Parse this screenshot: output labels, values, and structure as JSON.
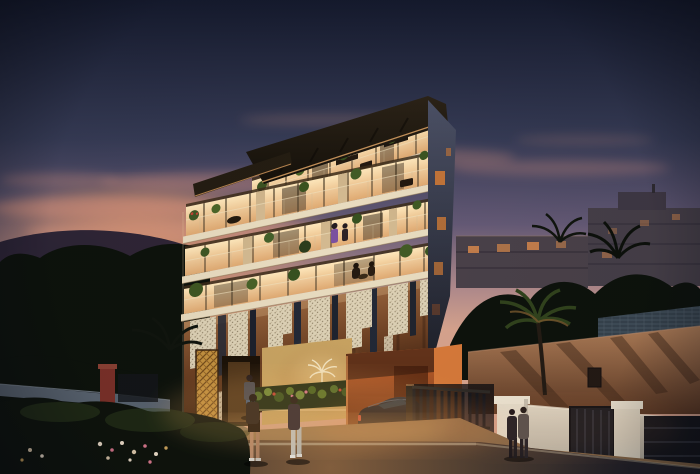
{
  "meta": {
    "description": "Dusk architectural rendering of a modern five-storey apartment residence with warmly lit balconies, decorative hanging mosaic facade panels, palm garden, street with pedestrians and a black sports coupe in the driveway",
    "time_of_day": "dusk"
  },
  "scene": {
    "main_building": {
      "label": "new-build residence",
      "storeys_visible": 5,
      "balcony_rows": 4,
      "features": [
        "dark roof slab with warm soffit lighting",
        "glass balcony railings",
        "potted plants and red geraniums on balconies",
        "hanging skyline-shaped mosaic panels",
        "golden lattice entrance panel",
        "palm-tree entrance emblem",
        "orange-lit garage recess"
      ]
    },
    "entrance_sign": {
      "emblem": "palm tree",
      "text_legible": false
    },
    "vehicles": [
      {
        "type": "black sports coupe",
        "location": "driveway",
        "count": 1
      }
    ],
    "pedestrians": [
      {
        "label": "couple crossing the street",
        "count": 2
      },
      {
        "label": "person on entrance walkway",
        "count": 1
      },
      {
        "label": "couple walking past boundary wall",
        "count": 2
      }
    ],
    "people_on_balconies": [
      {
        "label": "figure in purple on balcony",
        "count": 1
      },
      {
        "label": "seated figures on terrace",
        "count": 2
      }
    ],
    "background": {
      "apartment_blocks": 2,
      "lit_windows_approx": 8,
      "hills": "left horizon silhouette",
      "vegetation": "palm and tree silhouettes"
    },
    "street": {
      "road_edge_line": true,
      "left_garden_wall": "low wall with red pillar",
      "right_boundary": "cream wall with pillars, dark metal gates and fence"
    }
  },
  "palette": {
    "sky_top": "#151a2d",
    "sky_upper": "#363b55",
    "sky_mauve": "#655a76",
    "sky_rose": "#b08a8c",
    "sky_horizon": "#d8a48e",
    "sunset_glow": "#e89a66",
    "cloud": "#dd9480",
    "hill": "#262033",
    "bg_building": "#4a4149",
    "bg_window": "#d98a4c",
    "veg_dark": "#0d120c",
    "roof_dark": "#14100a",
    "interior_glow": "#ffe8bc",
    "interior_deep": "#dfa468",
    "slab_cream": "#e9dcc0",
    "side_face_top": "#4c5166",
    "side_face_bottom": "#1e2029",
    "side_window": "#cf7a36",
    "mosaic_cream": "#ded2b6",
    "mosaic_slate": "#232936",
    "bronze": "#6b3f22",
    "lattice_gold": "#c3913f",
    "garage_orange": "#d06a31",
    "car_black": "#0c0d11",
    "street_warm": "#86613f",
    "street_dark": "#242229",
    "road_line": "#cfc3a6",
    "wall_cream": "#e2dbc9",
    "gate_dark": "#1a1b20",
    "house_warm": "#b07e58",
    "tile_roof": "#45525f",
    "flower_pink": "#d4758a",
    "flower_red": "#c44434",
    "skin": "#b98a6a",
    "denim": "#4a5e78"
  }
}
